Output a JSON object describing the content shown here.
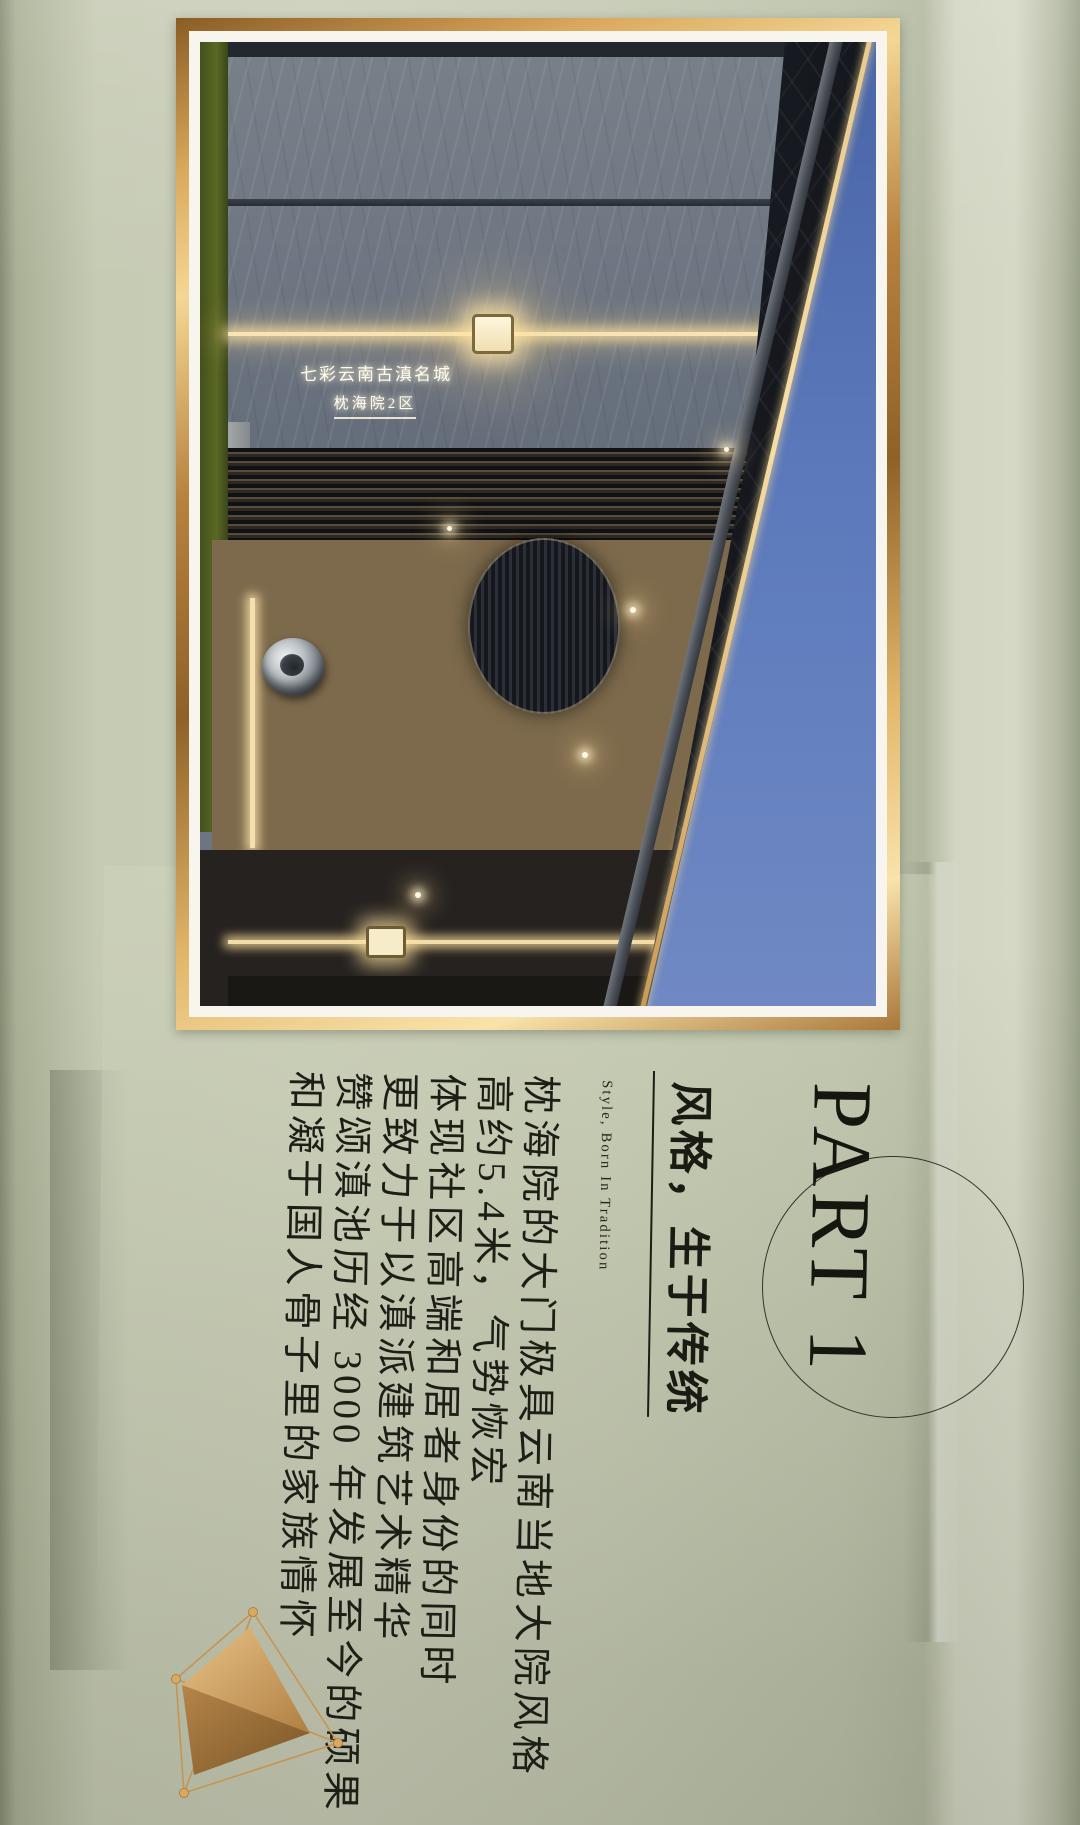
{
  "page": {
    "background_color": "#c3c8b1",
    "accent_gold": "#c8955a",
    "text_color": "#1d1e16"
  },
  "photo": {
    "sign_line1": "七彩云南古滇名城",
    "sign_line2": "枕海院2区",
    "frame_color": "#d9a85c",
    "mat_color": "#f7f5ee",
    "sky_color": "#5b79bb",
    "grass_color": "#5a6824",
    "wall_color": "#6d7582"
  },
  "section": {
    "part_label": "PART 1",
    "title": "风格，生于传统",
    "subtitle": "Style, Born In Tradition",
    "body_lines": [
      "枕海院的大门极具云南当地大院风格",
      "高约5.4米，气势恢宏",
      "体现社区高端和居者身份的同时",
      "更致力于以滇派建筑艺术精华",
      "赞颂滇池历经 3000 年发展至今的硕果",
      "和凝于国人骨子里的家族情怀"
    ]
  },
  "decor": {
    "circle_stroke": "#24251c",
    "pyramid_gold_light": "#e2b97c",
    "pyramid_gold_dark": "#8a5f2e"
  }
}
